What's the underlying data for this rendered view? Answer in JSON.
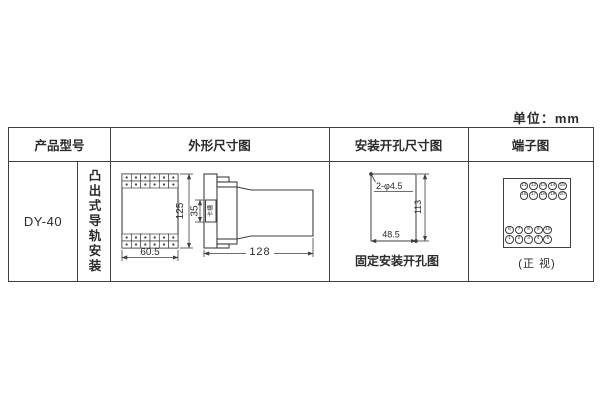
{
  "unit_label": "单位：mm",
  "colors": {
    "line": "#3f3f3f",
    "text": "#2b2b2b",
    "background": "#ffffff"
  },
  "table": {
    "headers": {
      "model": "产品型号",
      "outline": "外形尺寸图",
      "mounting": "安装开孔尺寸图",
      "terminal": "端子图"
    },
    "model": {
      "name": "DY-40",
      "mount_type": "凸出式导轨安装"
    },
    "outline": {
      "front": {
        "width": "60.5",
        "height": "125",
        "terminal_rows": 2,
        "terminal_cols": 6
      },
      "side": {
        "depth": "128",
        "slot_height": "35",
        "slot_label": "卡槽"
      }
    },
    "mounting": {
      "holes": "2-φ4.5",
      "vertical": "113",
      "horizontal": "48.5",
      "caption": "固定安装开孔图"
    },
    "terminal": {
      "top_rows": [
        [
          "11",
          "12",
          "13",
          "14",
          "15"
        ],
        [
          "16",
          "17",
          "18",
          "19",
          "20"
        ]
      ],
      "bottom_rows": [
        [
          "6",
          "7",
          "8",
          "9",
          "10"
        ],
        [
          "1",
          "2",
          "3",
          "4",
          "5"
        ]
      ],
      "caption": "(正 视)"
    }
  }
}
